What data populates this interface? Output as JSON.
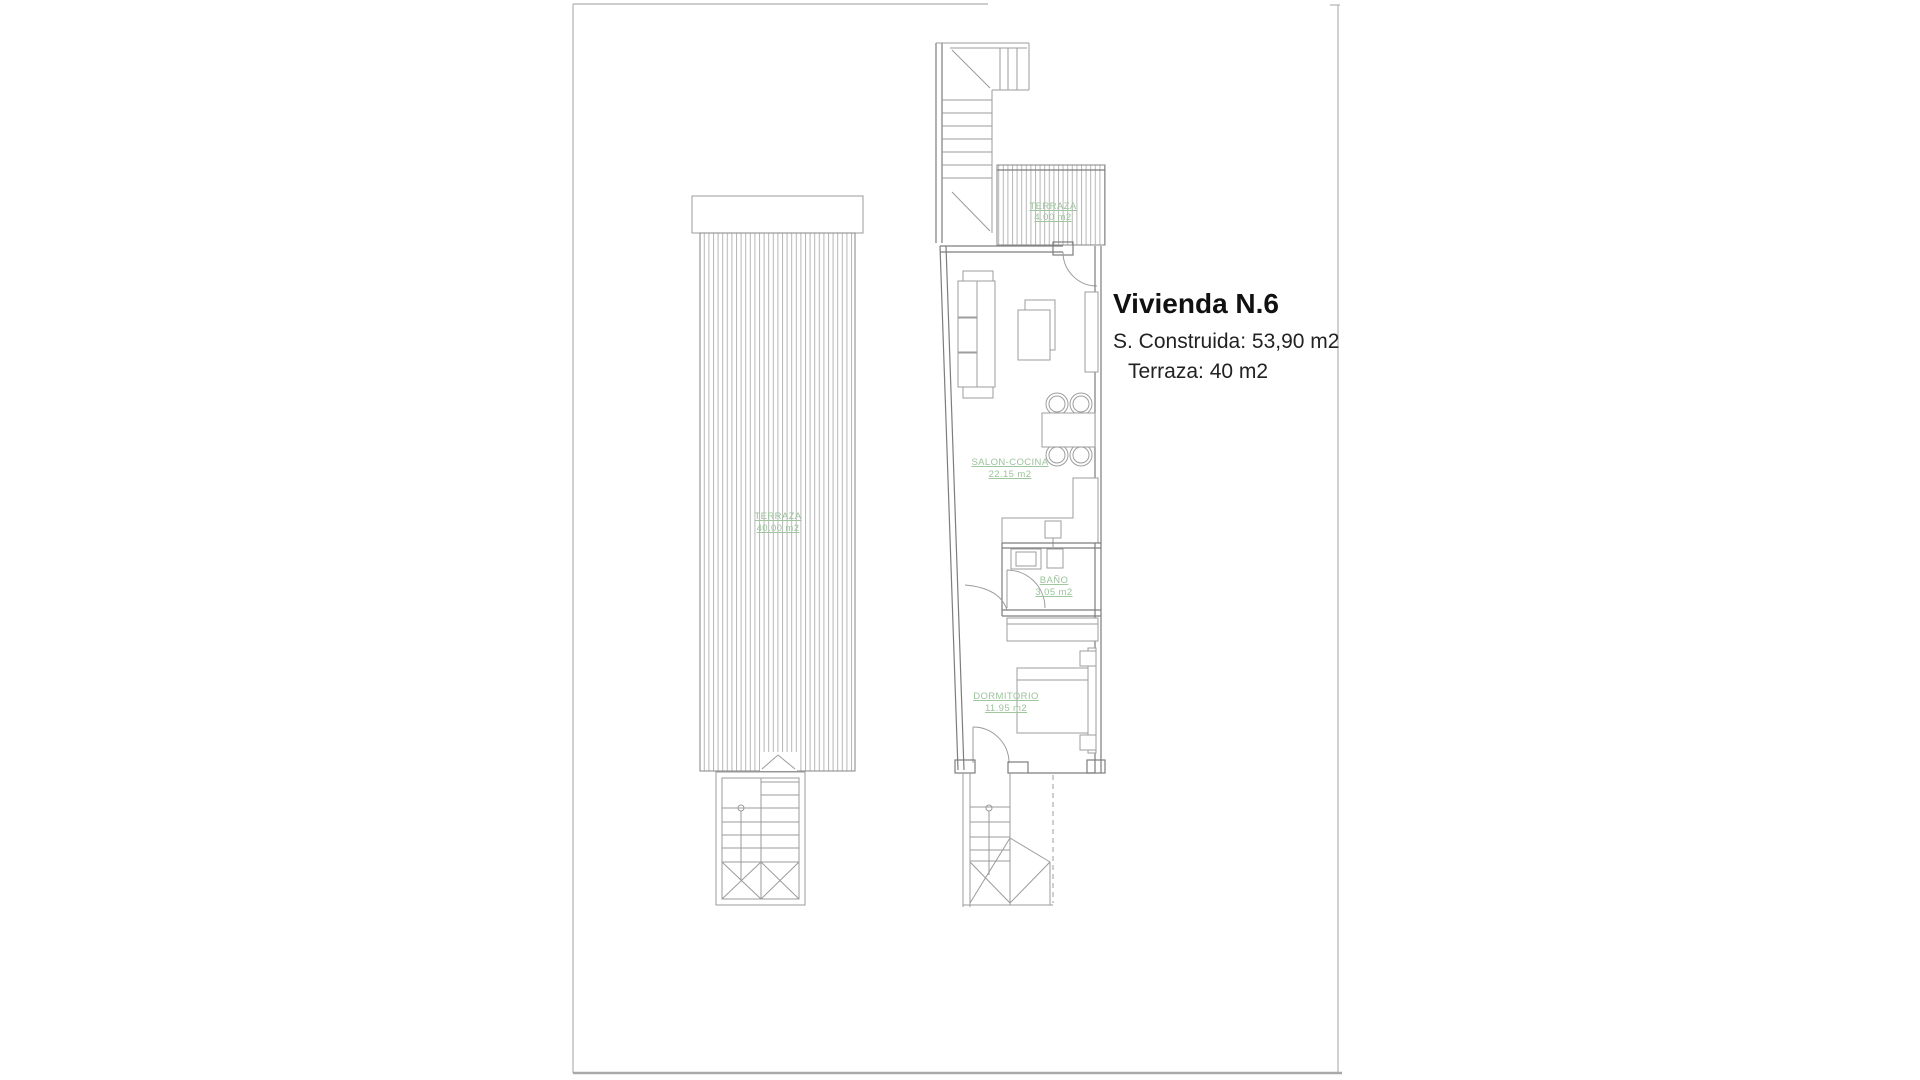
{
  "title_block": {
    "title": "Vivienda N.6",
    "line1": "S. Construida: 53,90 m2",
    "line2": "Terraza: 40 m2"
  },
  "rooms": {
    "solarium": {
      "name": "TERRAZA",
      "area": "40.00 m2"
    },
    "terraza": {
      "name": "TERRAZA",
      "area": "4.00 m2"
    },
    "salon": {
      "name": "SALON-COCINA",
      "area": "22.15 m2"
    },
    "bano": {
      "name": "BAÑO",
      "area": "3.05 m2"
    },
    "dormitorio": {
      "name": "DORMITORIO",
      "area": "11.95 m2"
    }
  },
  "colors": {
    "label_green": "#9cc39c",
    "line_gray": "#9b9b9b",
    "wall_gray": "#7d7d7d",
    "sheet_border": "#bdbdbd",
    "text_dark": "#1f1f1f"
  }
}
